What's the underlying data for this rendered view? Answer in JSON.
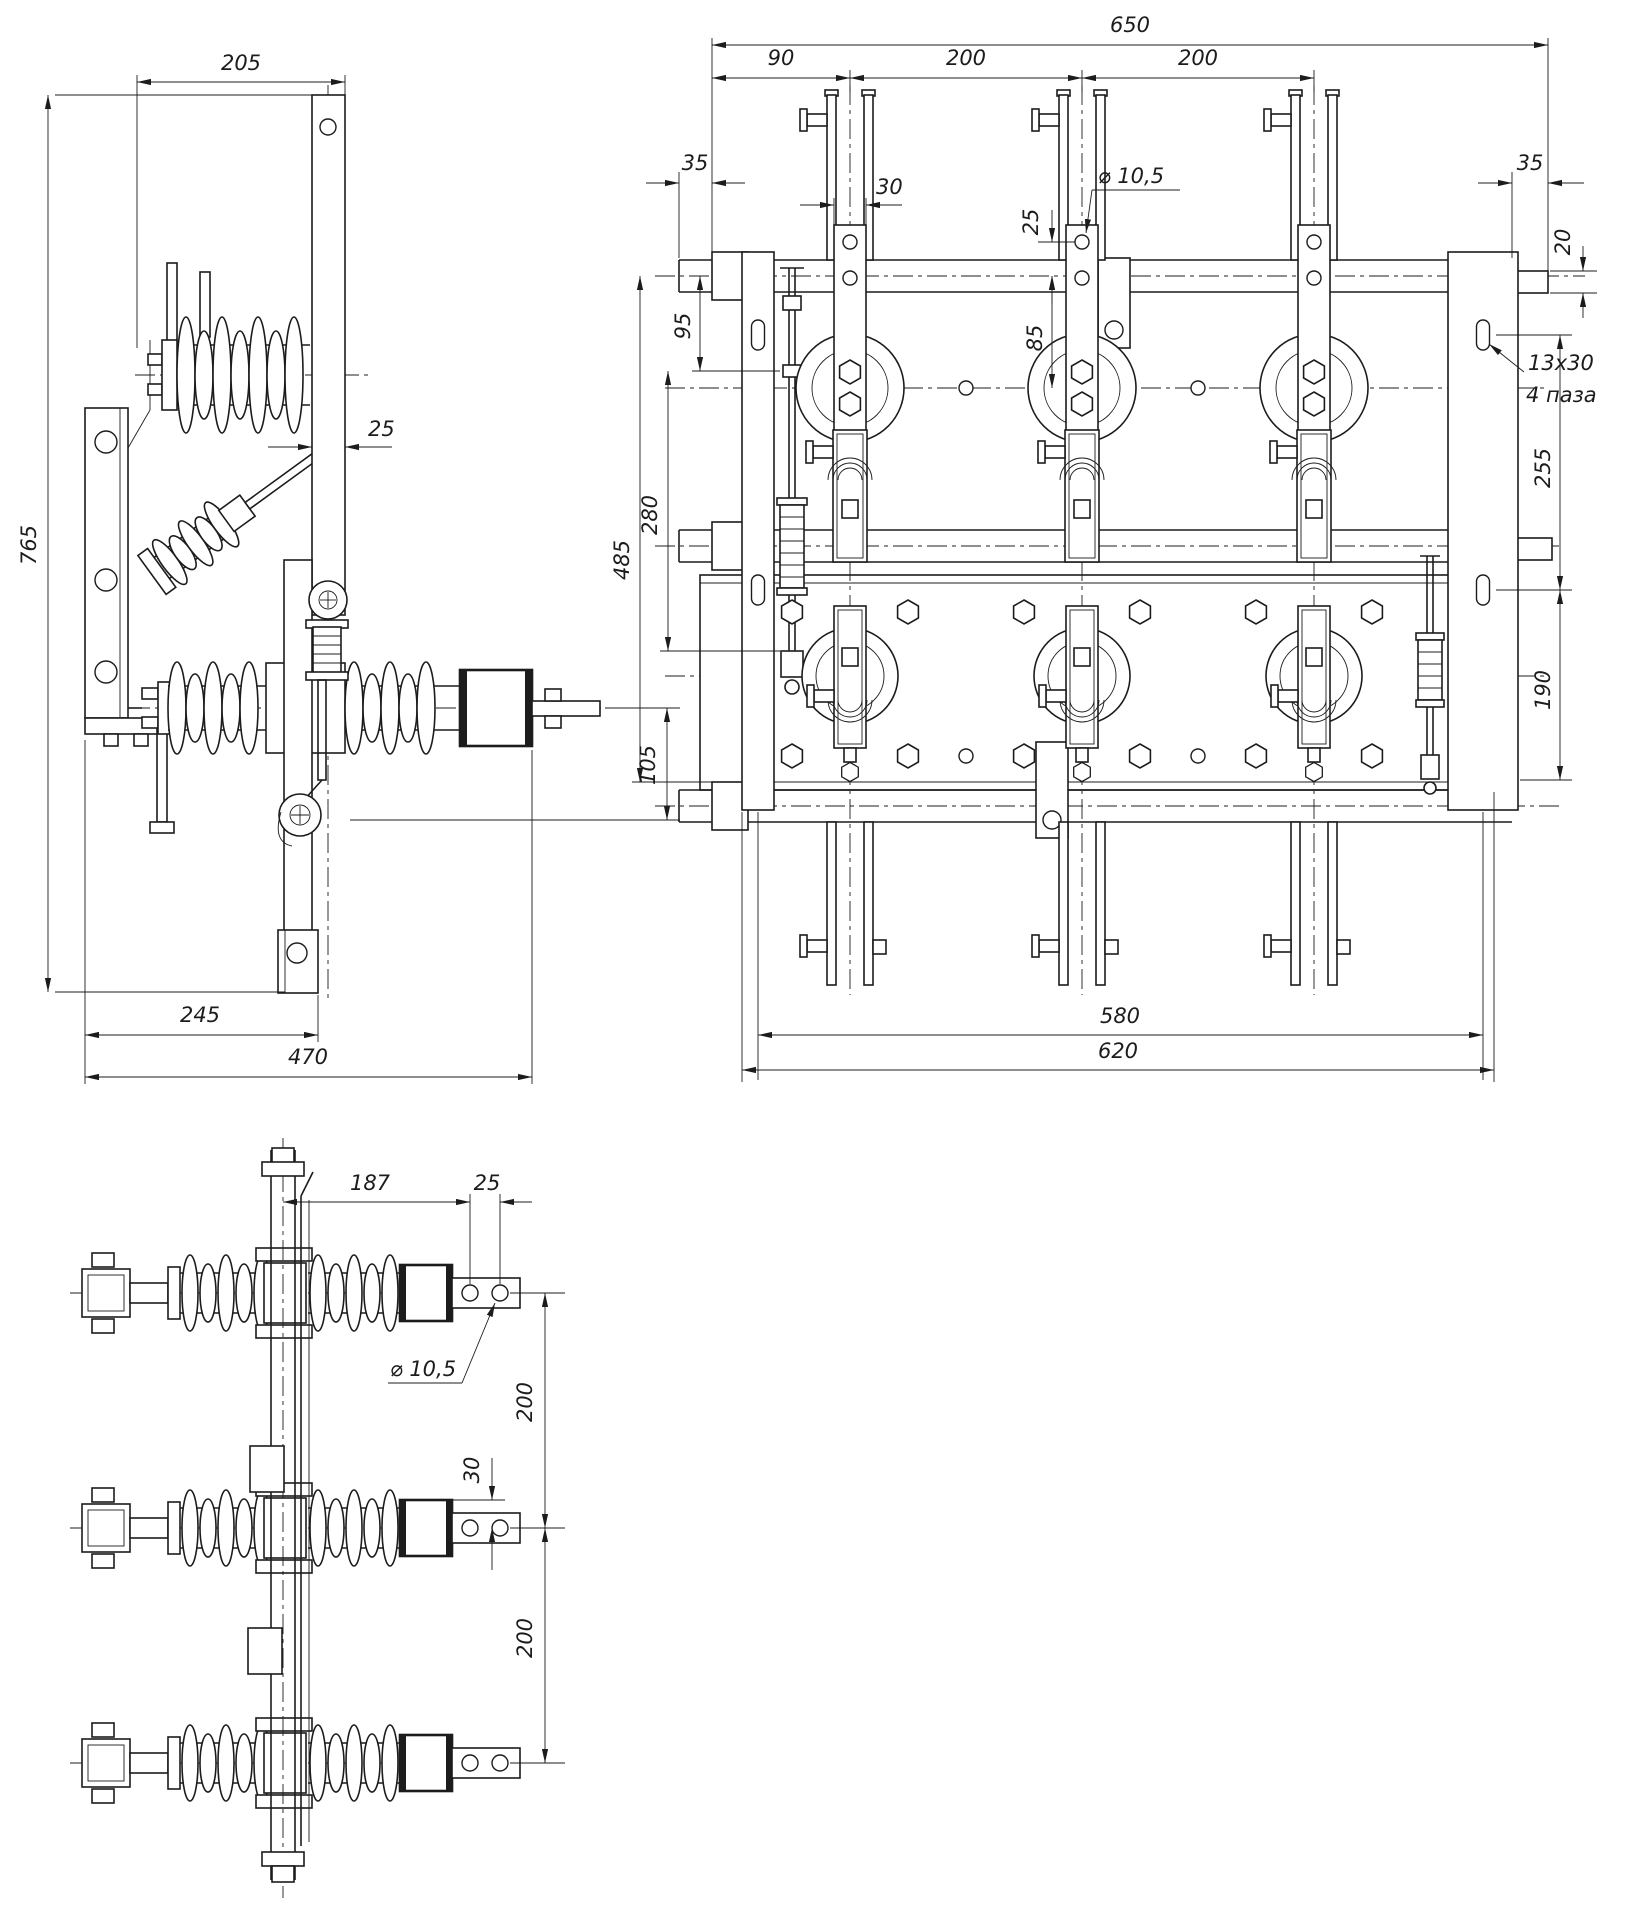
{
  "page": {
    "background": "#ffffff",
    "ink": "#1c1c1c"
  },
  "views": {
    "side": {
      "dims": {
        "top_width": "205",
        "overall_height": "765",
        "blade_thickness": "25",
        "terminal_offset": "105",
        "pivot_span": "245",
        "overall_width": "470"
      }
    },
    "front": {
      "dims": {
        "overall_width": "650",
        "first_pole_offset": "90",
        "pole_pitch_a": "200",
        "pole_pitch_b": "200",
        "left_overhang": "35",
        "blade_width": "30",
        "hole_to_axis": "25",
        "axis_drop": "85",
        "hole_diameter": "⌀ 10,5",
        "right_overhang": "35",
        "end_step": "20",
        "rod_top_offset": "95",
        "rod_length": "280",
        "frame_height": "485",
        "slot_size": "13x30",
        "slot_note": "4 паза",
        "slot_span_upper": "255",
        "slot_span_lower": "190",
        "mount_span": "580",
        "frame_width": "620"
      }
    },
    "plan": {
      "dims": {
        "terminal_reach": "187",
        "hole_pitch": "25",
        "hole_diameter": "⌀ 10,5",
        "pole_pitch_a": "200",
        "contact_offset": "30",
        "pole_pitch_b": "200"
      }
    }
  }
}
